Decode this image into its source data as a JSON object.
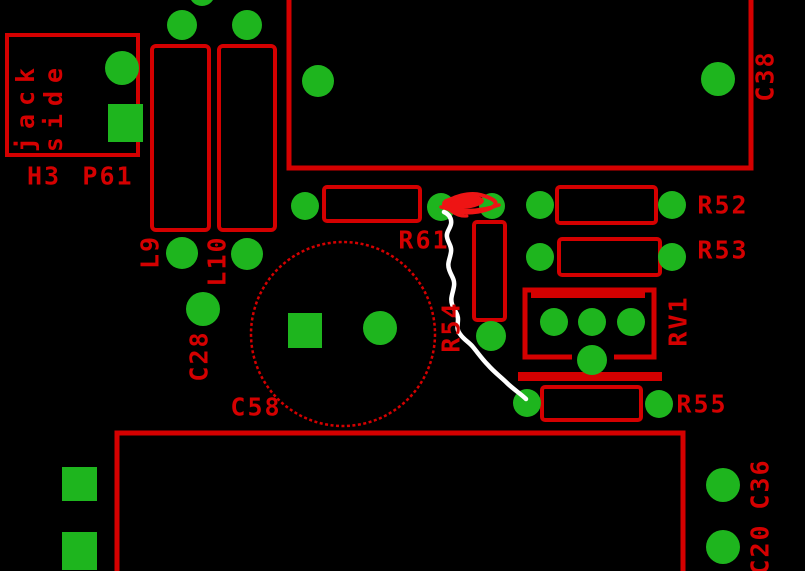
{
  "board": {
    "colors": {
      "background": "#000000",
      "silkscreen": "#d40000",
      "pad": "#1eb51e",
      "marker": "#ee1414",
      "trace_line": "#ffffff"
    },
    "components": {
      "h3": {
        "refdes": "H3",
        "inner_label_line1": "jack",
        "inner_label_line2": "side"
      },
      "p61": {
        "refdes": "P61"
      },
      "l9": {
        "refdes": "L9"
      },
      "l10": {
        "refdes": "L10"
      },
      "c28": {
        "refdes": "C28"
      },
      "c58": {
        "refdes": "C58"
      },
      "c38": {
        "refdes": "C38"
      },
      "r61": {
        "refdes": "R61"
      },
      "r54": {
        "refdes": "R54"
      },
      "r52": {
        "refdes": "R52"
      },
      "r53": {
        "refdes": "R53"
      },
      "rv1": {
        "refdes": "RV1"
      },
      "r55": {
        "refdes": "R55"
      },
      "c36": {
        "refdes": "C36"
      },
      "c20": {
        "refdes": "C20"
      }
    }
  }
}
